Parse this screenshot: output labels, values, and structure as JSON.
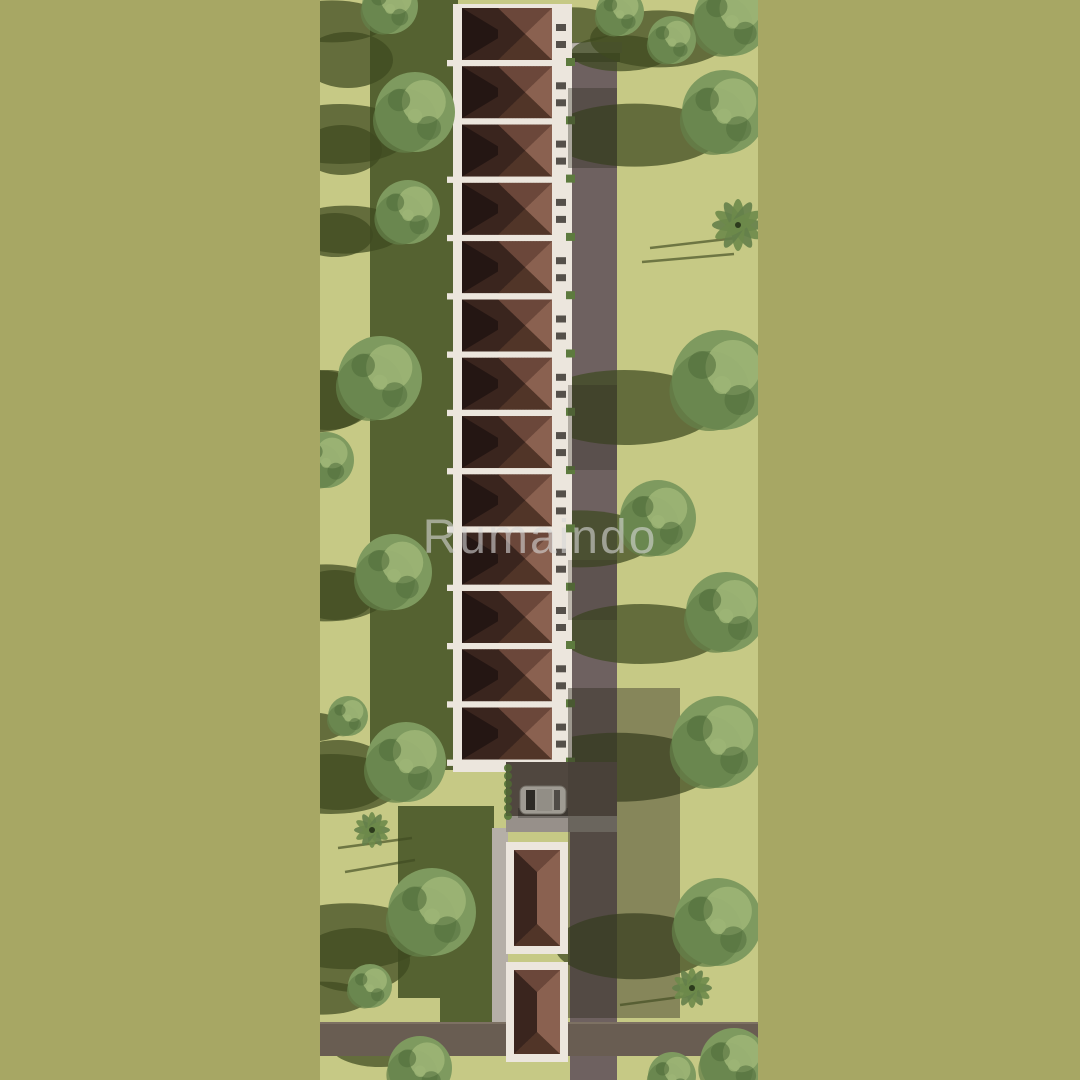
{
  "watermark": {
    "text": "Rumaindo"
  },
  "palette": {
    "border": "#a7a764",
    "grass": "#c6c985",
    "band": "#556231",
    "shadow": "#3f4a20",
    "shade": "#2e2c20",
    "road": "#6e6160",
    "road_h": "#695d52",
    "road_dark": "#5d524c",
    "apron": "#97908a",
    "gate": "#b8b2ac",
    "fence": "#3f3937",
    "wall": "#ece6dd",
    "walkway": "#b5afa7",
    "roof_base": "#5e4034",
    "roof_top": "#6b473a",
    "roof_right": "#8a6150",
    "roof_bottom": "#513528",
    "roof_left": "#3a251e",
    "roof_dark": "#241613",
    "window": "#55504a",
    "hedge": "#5d7a3e",
    "car_body": "#cbc7bf",
    "car_glass": "#2e2b29",
    "tree_base": "#7e9a5f",
    "tree_dark": "#64804a",
    "tree_light": "#9db576",
    "tree_speck": "#516e3c",
    "palm": "#6d8a4a"
  },
  "photo": {
    "left": 320,
    "width": 438,
    "height": 1080
  },
  "main_row": {
    "units": 13,
    "base_x": 133,
    "base_y": 4,
    "base_w": 119,
    "base_h": 768,
    "roof_x": 142,
    "roof_w": 90,
    "start_y": 8,
    "pitch": 58.3,
    "roof_h": 52,
    "facade_x": 232,
    "facade_w": 18
  },
  "rear_row": {
    "units": [
      {
        "y": 842,
        "h": 112
      },
      {
        "y": 962,
        "h": 100
      }
    ],
    "x": 186,
    "w": 62,
    "roof_inset": 8,
    "roof_x": 194,
    "roof_w": 46
  },
  "roads": {
    "vertical": {
      "x": 250,
      "w": 47,
      "y": 62,
      "h": 1018
    },
    "gate": {
      "x": 244,
      "y": 42,
      "w": 58,
      "h": 11
    },
    "fence": {
      "x": 246,
      "y": 53,
      "w": 54,
      "h": 9
    },
    "horizontal_left": {
      "x": 0,
      "y": 1022,
      "w": 186,
      "h": 34
    },
    "horizontal_right": {
      "x": 248,
      "y": 1022,
      "w": 190,
      "h": 34
    },
    "walkway": {
      "x": 172,
      "y": 828,
      "w": 16,
      "h": 194
    },
    "driveway": {
      "x": 186,
      "y": 762,
      "w": 111,
      "h": 66
    },
    "apron": {
      "x": 186,
      "y": 816,
      "w": 111,
      "h": 16
    }
  },
  "dark_rects": [
    {
      "x": 50,
      "y": 0,
      "w": 88,
      "h": 770
    },
    {
      "x": 78,
      "y": 806,
      "w": 96,
      "h": 192
    },
    {
      "x": 120,
      "y": 996,
      "w": 52,
      "h": 26
    }
  ],
  "grass_blobs": [
    {
      "cx": 28,
      "cy": 60,
      "rx": 45,
      "ry": 28
    },
    {
      "cx": 22,
      "cy": 150,
      "rx": 40,
      "ry": 25
    },
    {
      "cx": 15,
      "cy": 235,
      "rx": 38,
      "ry": 22
    },
    {
      "cx": 8,
      "cy": 400,
      "rx": 42,
      "ry": 30
    },
    {
      "cx": 15,
      "cy": 595,
      "rx": 40,
      "ry": 25
    },
    {
      "cx": 18,
      "cy": 775,
      "rx": 55,
      "ry": 35
    },
    {
      "cx": 35,
      "cy": 960,
      "rx": 55,
      "ry": 32
    },
    {
      "cx": 60,
      "cy": 1045,
      "rx": 50,
      "ry": 22
    }
  ],
  "road_shades": [
    {
      "x": 248,
      "y": 88,
      "w": 49,
      "h": 80,
      "o": 0.35
    },
    {
      "x": 248,
      "y": 385,
      "w": 49,
      "h": 85,
      "o": 0.3
    },
    {
      "x": 248,
      "y": 560,
      "w": 49,
      "h": 60,
      "o": 0.25
    },
    {
      "x": 248,
      "y": 688,
      "w": 112,
      "h": 330,
      "o": 0.42
    },
    {
      "x": 186,
      "y": 762,
      "w": 62,
      "h": 54,
      "o": 0.28
    }
  ],
  "trees": [
    {
      "x": 70,
      "y": 6,
      "r": 28,
      "s": 60
    },
    {
      "x": 95,
      "y": 112,
      "r": 40,
      "s": 70
    },
    {
      "x": 88,
      "y": 212,
      "r": 32,
      "s": 60
    },
    {
      "x": 60,
      "y": 378,
      "r": 42,
      "s": 55
    },
    {
      "x": 6,
      "y": 460,
      "r": 28,
      "s": 0
    },
    {
      "x": 74,
      "y": 572,
      "r": 38,
      "s": 60
    },
    {
      "x": 28,
      "y": 716,
      "r": 20,
      "s": 45
    },
    {
      "x": 86,
      "y": 762,
      "r": 40,
      "s": 70
    },
    {
      "type": "palm",
      "x": 52,
      "y": 830,
      "r": 18,
      "s": 0
    },
    {
      "x": 112,
      "y": 912,
      "r": 44,
      "s": 80
    },
    {
      "x": 50,
      "y": 986,
      "r": 22,
      "s": 50
    },
    {
      "x": 100,
      "y": 1068,
      "r": 32,
      "s": 0
    },
    {
      "x": 300,
      "y": 12,
      "r": 24,
      "s": 50
    },
    {
      "x": 412,
      "y": 18,
      "r": 38,
      "s": 70
    },
    {
      "x": 352,
      "y": 40,
      "r": 24,
      "s": 55
    },
    {
      "x": 404,
      "y": 112,
      "r": 42,
      "s": 95
    },
    {
      "type": "palm",
      "x": 418,
      "y": 225,
      "r": 26,
      "s": 0
    },
    {
      "x": 402,
      "y": 380,
      "r": 50,
      "s": 95
    },
    {
      "x": 338,
      "y": 518,
      "r": 38,
      "s": 80
    },
    {
      "x": 406,
      "y": 612,
      "r": 40,
      "s": 90
    },
    {
      "x": 398,
      "y": 742,
      "r": 46,
      "s": 110
    },
    {
      "x": 398,
      "y": 922,
      "r": 44,
      "s": 80
    },
    {
      "type": "palm",
      "x": 372,
      "y": 988,
      "r": 20,
      "s": 0
    },
    {
      "x": 414,
      "y": 1062,
      "r": 34,
      "s": 0
    },
    {
      "x": 352,
      "y": 1076,
      "r": 24,
      "s": 0
    }
  ],
  "pole_shadows": [
    {
      "x1": 18,
      "y1": 848,
      "x2": 92,
      "y2": 838
    },
    {
      "x1": 25,
      "y1": 872,
      "x2": 95,
      "y2": 860
    },
    {
      "x1": 330,
      "y1": 248,
      "x2": 416,
      "y2": 238
    },
    {
      "x1": 322,
      "y1": 262,
      "x2": 414,
      "y2": 254
    },
    {
      "x1": 300,
      "y1": 1005,
      "x2": 368,
      "y2": 996
    }
  ],
  "car": {
    "x": 200,
    "y": 786,
    "w": 46,
    "h": 28
  }
}
